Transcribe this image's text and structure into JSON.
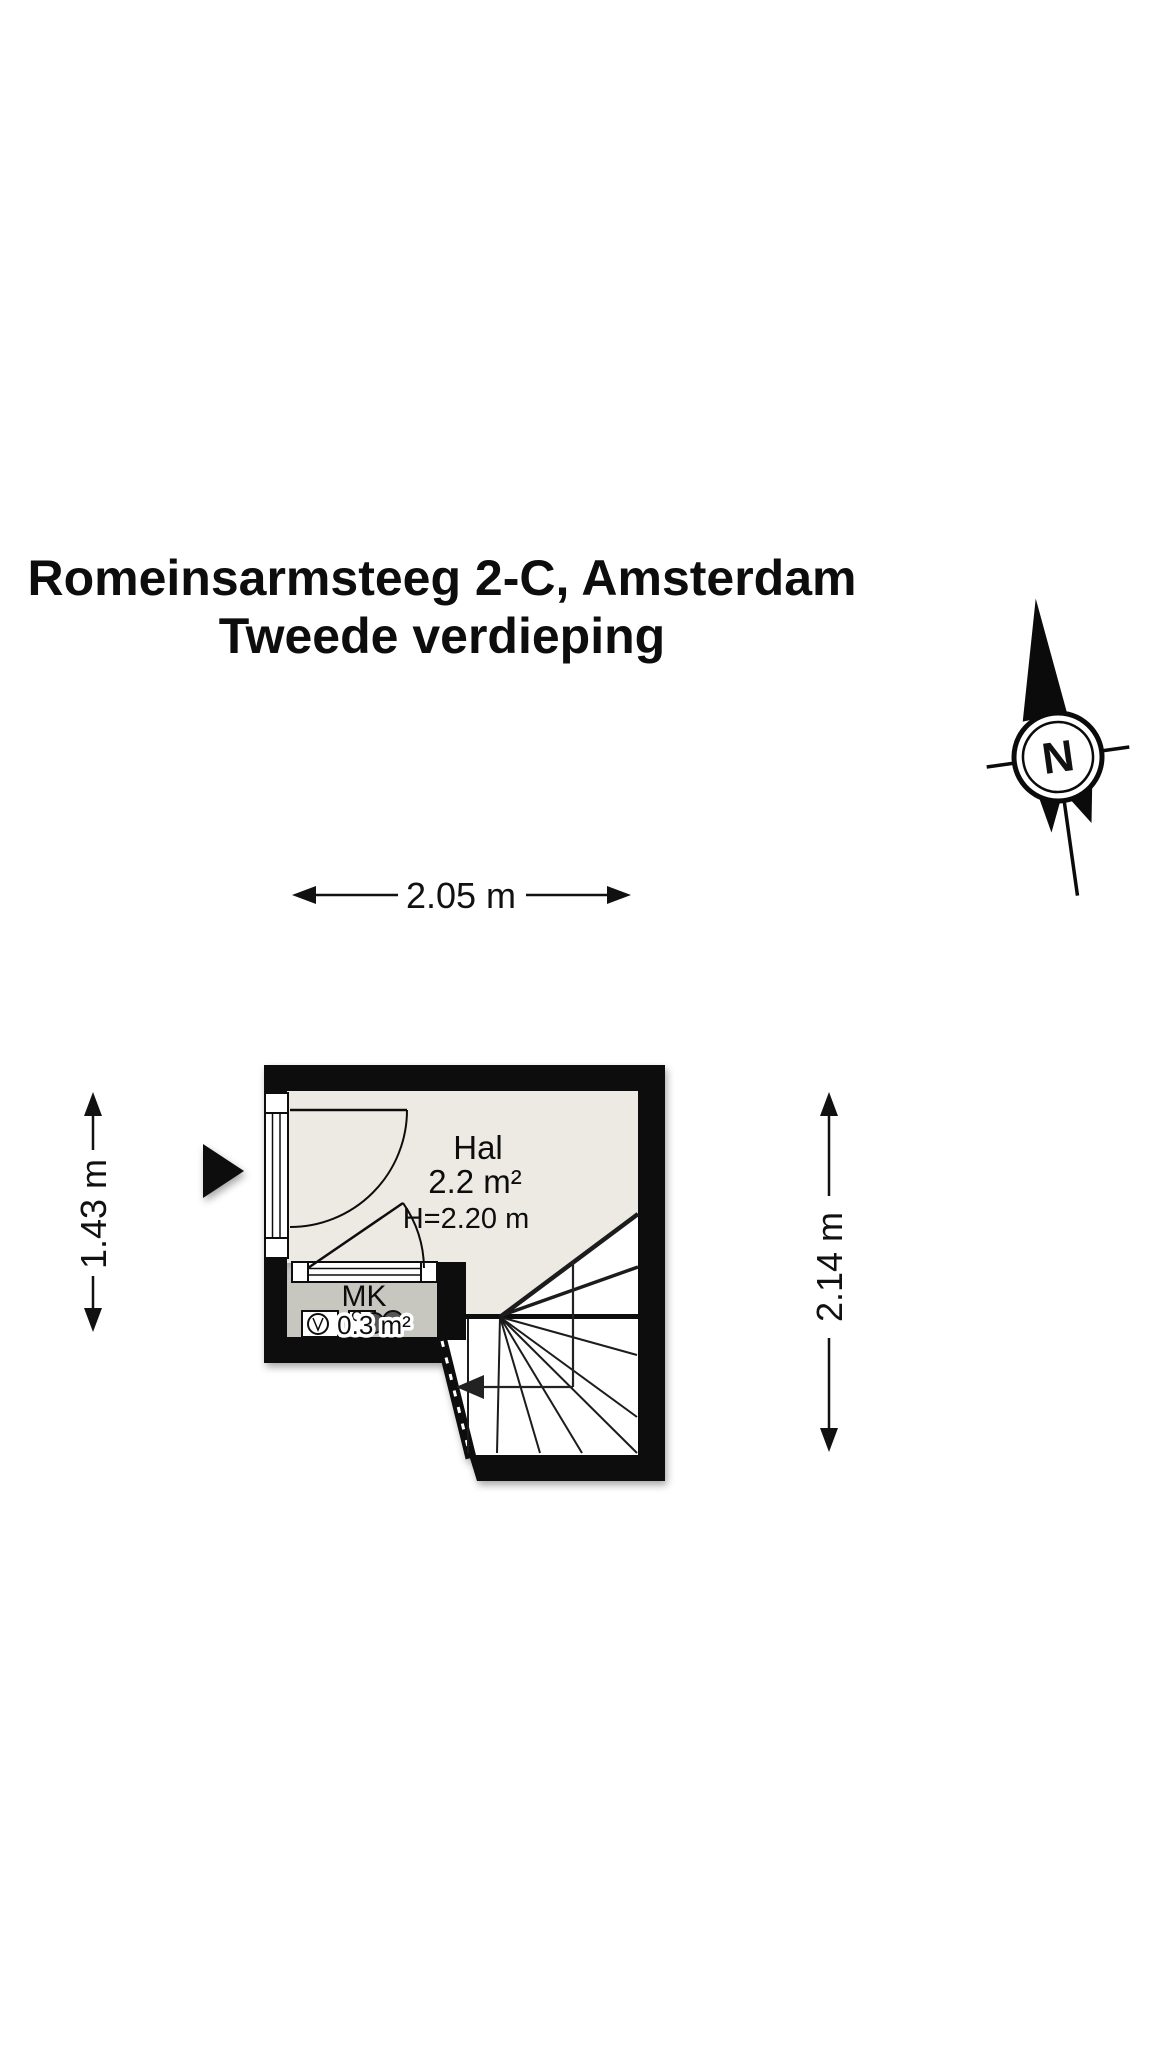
{
  "title": {
    "line1": "Romeinsarmsteeg 2-C, Amsterdam",
    "line2": "Tweede verdieping"
  },
  "compass": {
    "north_label": "N"
  },
  "dimensions": {
    "top_width": "2.05 m",
    "left_height": "1.43 m",
    "right_height": "2.14 m"
  },
  "rooms": {
    "hal": {
      "name": "Hal",
      "area": "2.2 m²",
      "ceiling_height": "H=2.20 m",
      "floor_color": "#eceae3"
    },
    "mk": {
      "name": "MK",
      "area": "0.3 m²",
      "floor_color": "#c7c7c0"
    }
  },
  "icons": {
    "entrance_arrow": "entrance-direction-arrow",
    "stairs_arrow": "stairs-down-arrow",
    "meters": [
      "electric-meter-icon",
      "gas-meter-icon"
    ]
  },
  "colors": {
    "wall": "#0b0b0b",
    "line": "#111111",
    "stair_fill": "#ffffff",
    "page_background": "#ffffff"
  }
}
